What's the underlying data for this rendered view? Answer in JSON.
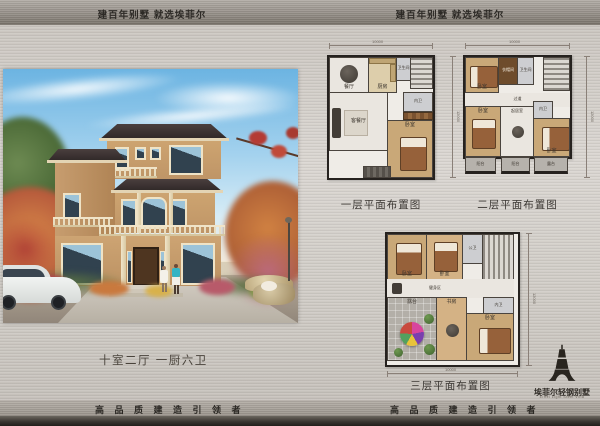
{
  "header": {
    "slogan_left": "建百年别墅  就选埃菲尔",
    "slogan_right": "建百年别墅  就选埃菲尔"
  },
  "footer": {
    "slogan_left": "高 品 质 建 造 引 领 者",
    "slogan_right": "高 品 质 建 造 引 领 者"
  },
  "brand": {
    "name_cn": "埃菲尔轻钢别墅",
    "name_en": "Eiffel Light Steel Villa"
  },
  "photo": {
    "spec": "十室二厅 一厨六卫"
  },
  "plans": [
    {
      "caption": "一层平面布置图",
      "dim_width": "10000",
      "dim_height": "12000",
      "rooms": {
        "dining": "餐厅",
        "kitchen": "厨房",
        "bath": "卫生间",
        "living": "客餐厅",
        "ensuite": "内卫",
        "bedroom": "卧室"
      }
    },
    {
      "caption": "二层平面布置图",
      "dim_width": "10000",
      "dim_height": "12000",
      "rooms": {
        "bedroom1": "卧室",
        "cloak": "衣帽间",
        "bath": "卫生间",
        "corridor": "过道",
        "bedroom2": "卧室",
        "sitting": "起居室",
        "ensuite": "内卫",
        "bedroom3": "卧室",
        "balcony1": "阳台",
        "balcony2": "阳台",
        "balcony3": "露台"
      }
    },
    {
      "caption": "三层平面布置图",
      "dim_width": "10000",
      "dim_height": "12000",
      "rooms": {
        "bedroom1": "卧室",
        "bedroom2": "卧室",
        "bath": "公卫",
        "gym": "健身区",
        "terrace": "露台",
        "study": "书房",
        "ensuite": "内卫",
        "bedroom3": "卧室"
      }
    }
  ],
  "colors": {
    "metal_light": "#d8d4cf",
    "metal_band": "#8d8881",
    "ink": "#2e2b27",
    "wall_beige": "#c79d6f",
    "roof": "#352c2b",
    "sky": "#7dbde6",
    "wood_floor": "#c9a878",
    "plan_wall": "#26221f",
    "accent_parasol": "#d8459e"
  }
}
